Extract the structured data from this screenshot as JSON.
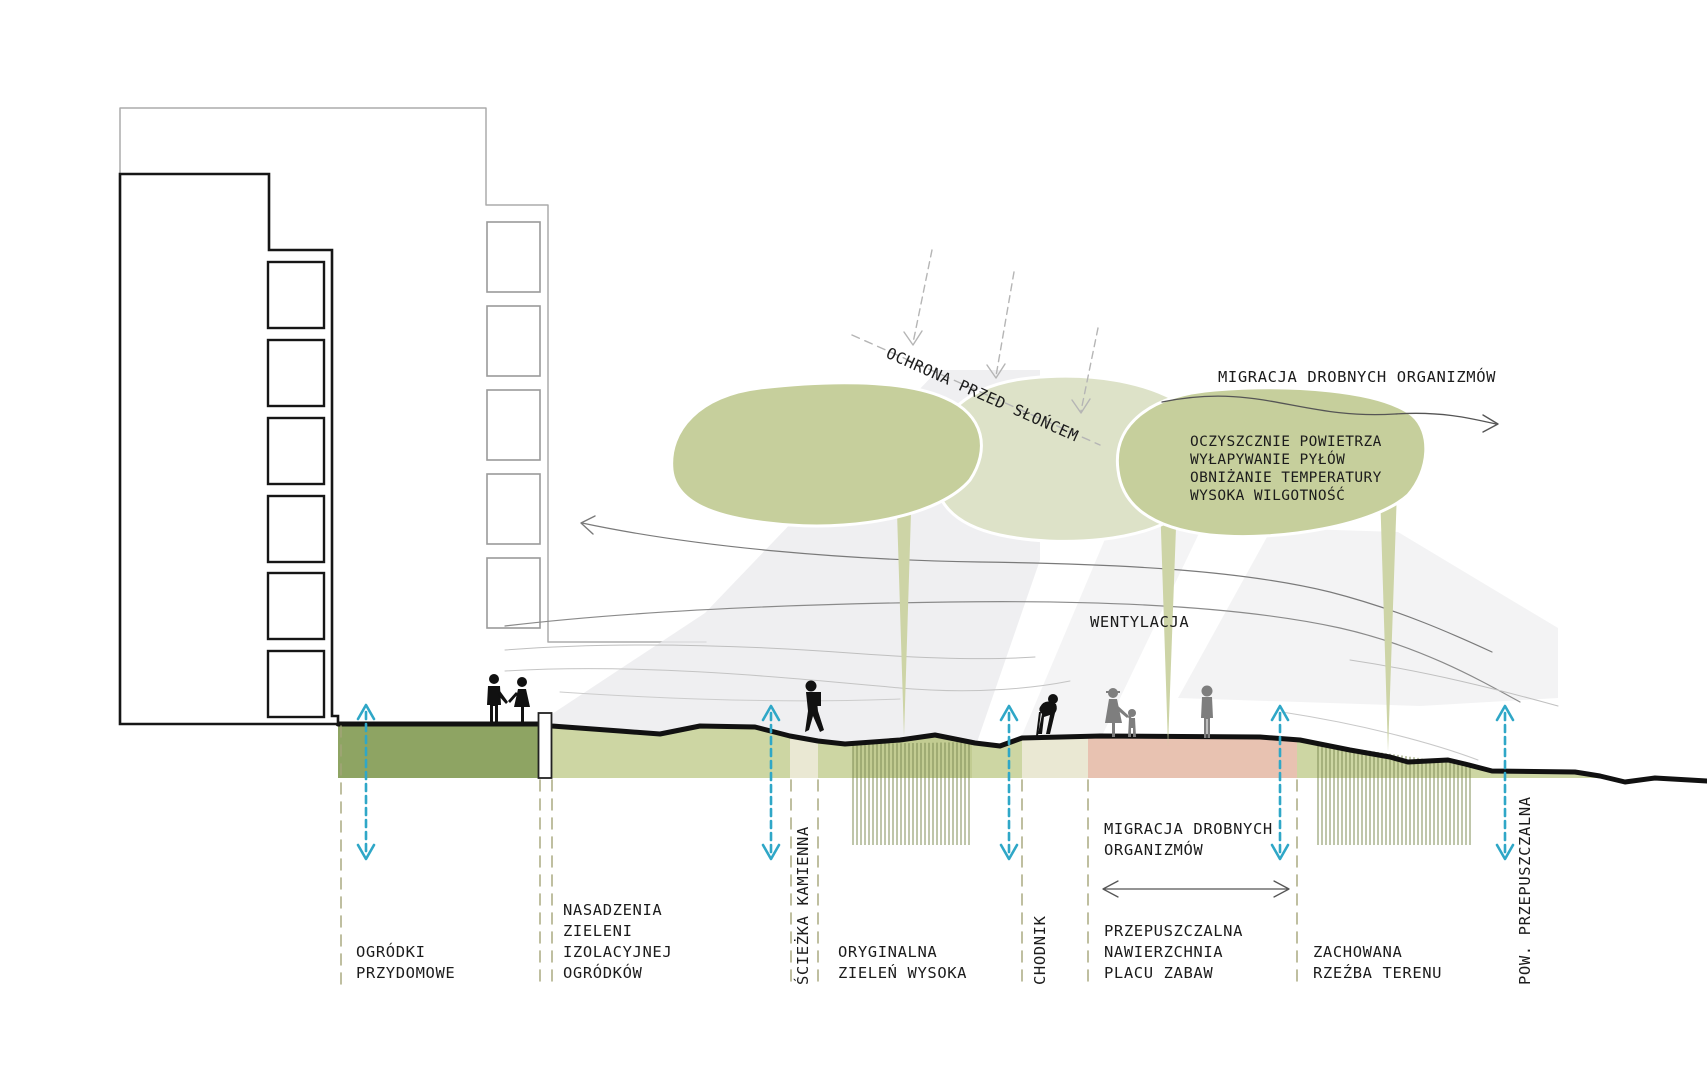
{
  "diagram_title": "landscape-section-diagram",
  "colors": {
    "teal": "#2fa7c7",
    "ink": "#161616",
    "canopy_dark": "#c6cf9c",
    "canopy_light": "#dde2c8",
    "trunk": "#cdd4a6",
    "garden_dark": "#8ea463",
    "green_light": "#cdd6a3",
    "green_hatch": "#c2cc92",
    "paving_beige": "#eae8d3",
    "playground_pink": "#e8c2b1",
    "hatch_line": "#7f8c55",
    "dashed_zone": "#a4a478",
    "shadow": "#ebebed",
    "ray_gray": "#b5b5b5",
    "people_gray": "#7e7e7e"
  },
  "annotations": {
    "sun_protection": "OCHRONA PRZED SŁOŃCEM",
    "migration_top": "MIGRACJA DROBNYCH ORGANIZMÓW",
    "tree_benefits": [
      "OCZYSZCZNIE POWIETRZA",
      "WYŁAPYWANIE PYŁÓW",
      "OBNIŻANIE TEMPERATURY",
      "WYSOKA WILGOTNOŚĆ"
    ],
    "ventilation": "WENTYLACJA",
    "migration_ground": [
      "MIGRACJA DROBNYCH",
      "ORGANIZMÓW"
    ]
  },
  "zone_labels": {
    "ogrodki": [
      "OGRÓDKI",
      "PRZYDOMOWE"
    ],
    "nasadzenia": [
      "NASADZENIA",
      "ZIELENI",
      "IZOLACYJNEJ",
      "OGRÓDKÓW"
    ],
    "sciezka": "ŚCIEŻKA KAMIENNA",
    "oryginalna": [
      "ORYGINALNA",
      "ZIELEŃ WYSOKA"
    ],
    "chodnik": "CHODNIK",
    "plac_zabaw": [
      "PRZEPUSZCZALNA",
      "NAWIERZCHNIA",
      "PLACU ZABAW"
    ],
    "zachowana": [
      "ZACHOWANA",
      "RZEŹBA TERENU"
    ],
    "pow_przepuszczalna": "POW. PRZEPUSZCZALNA"
  }
}
